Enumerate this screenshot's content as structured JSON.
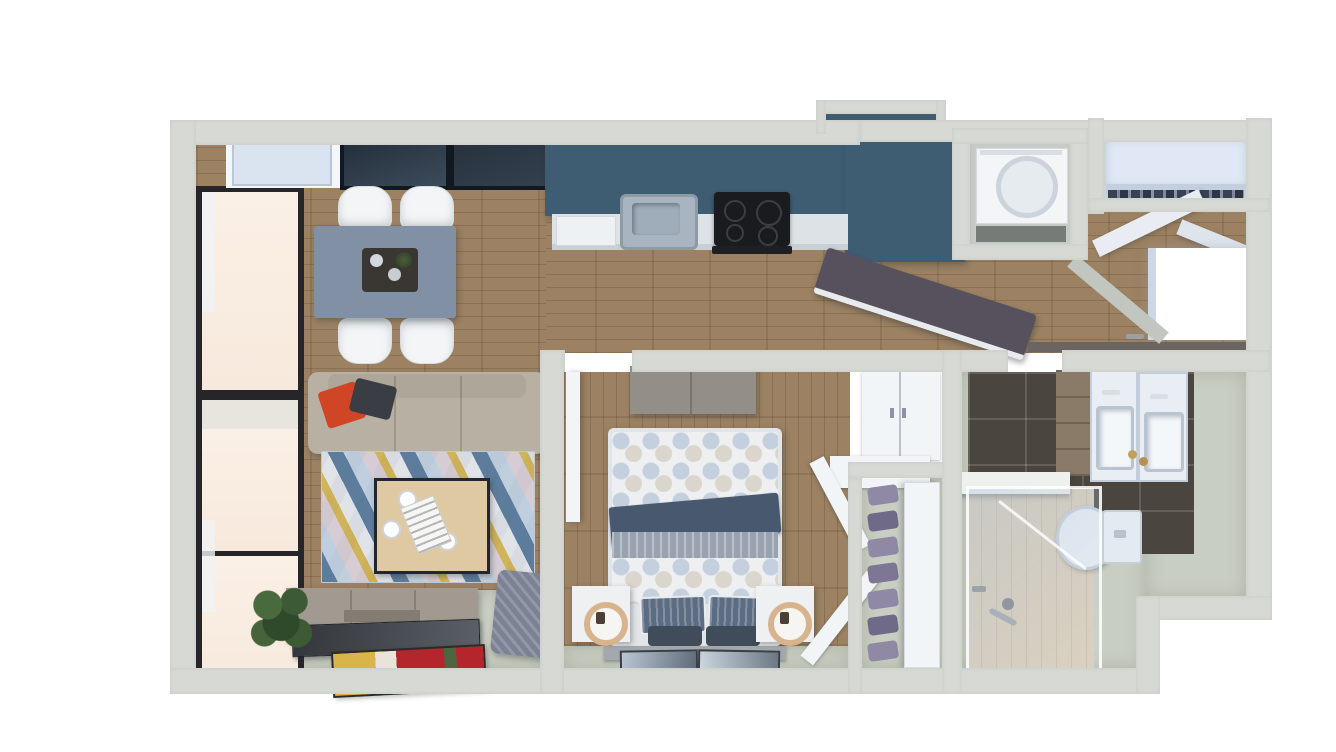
{
  "meta": {
    "kind": "3d-floor-plan-top-down-render",
    "background": "#ffffff",
    "visible_text": "none"
  },
  "palette": {
    "wall": "#d6d9d4",
    "wallShade": "#c2c6c1",
    "floorWood": "#9c8162",
    "floorPale": "#c9cec2",
    "tileDark": "#4a453e",
    "showerFloor": "#d9ccb7",
    "glassWarm": "#f7e9dc",
    "frameDark": "#26262a",
    "counterBlue": "#3e5c72",
    "counterWhite": "#dde2e6",
    "steel": "#a8b4c0",
    "stoveBlack": "#1a1b1e",
    "tableBlue": "#8290a6",
    "chairWhite": "#f3f5f7",
    "sofaTaupe": "#b8b0a3",
    "pillowRed": "#cf4526",
    "pillowDark": "#3a3e44",
    "rugBase": "#d9dce1",
    "rugBlue": "#4f7195",
    "rugLightBlue": "#a9c0d6",
    "rugYellow": "#c8a22b",
    "rugPink": "#cbb9c3",
    "woodLight": "#dec9a2",
    "consoleGray": "#a29a90",
    "tvDark": "#34373c",
    "plantGreen": "#3c5a34",
    "poufGray": "#7b8294",
    "bedWhite": "#edeff0",
    "bedDark": "#48596f",
    "bedGray": "#99a3b0",
    "nightstand": "#eef0f2",
    "lampBrass": "#d8b48e",
    "doorWhite": "#f2f5f8",
    "closetShelf": "#dfe8f4",
    "shoes": "#8f89a6",
    "vanityWood": "#8a7a68",
    "fixtureWhite": "#e9eef4",
    "ledge": "#6a6560",
    "artRed": "#b5252c",
    "artYellow": "#d9b44a",
    "artGreen": "#4a6741",
    "barDark": "#56515c"
  },
  "scene": {
    "rooms": [
      {
        "id": "living-dining-room",
        "floor": "wood + pale carpet band",
        "furniture": [
          "dining-table",
          "dining-chairs-x4",
          "sofa",
          "geometric-rug",
          "coffee-table",
          "tv-console",
          "leaning-tv-panel",
          "potted-plant",
          "knit-pouf",
          "floor-art-mat",
          "window-wall",
          "transom-panels"
        ]
      },
      {
        "id": "kitchen",
        "floor": "wood",
        "furniture": [
          "blue-l-counter",
          "sink",
          "cooktop",
          "dishwasher",
          "angled-bar-counter"
        ]
      },
      {
        "id": "entry-hall",
        "floor": "wood",
        "furniture": [
          "washer-nook",
          "coat-closet-shelf",
          "open-closet-doors",
          "open-entry-door",
          "wall-ledge"
        ]
      },
      {
        "id": "bedroom",
        "floor": "wood + pale band",
        "furniture": [
          "bed-queen",
          "nightstand-left",
          "nightstand-right",
          "brass-lamps",
          "tv-dresser",
          "wardrobe",
          "wall-shelf",
          "open-wardrobe-doors",
          "leaning-picture-frames"
        ]
      },
      {
        "id": "shoe-closet",
        "floor": "pale",
        "furniture": [
          "shoe-rack-7-pairs",
          "sliding-door-panel"
        ]
      },
      {
        "id": "bathroom",
        "floor": "dark tile + shower tile",
        "furniture": [
          "vanity-double",
          "sinks-x2",
          "toilet",
          "glass-shower",
          "half-wall-ledge"
        ]
      }
    ]
  }
}
